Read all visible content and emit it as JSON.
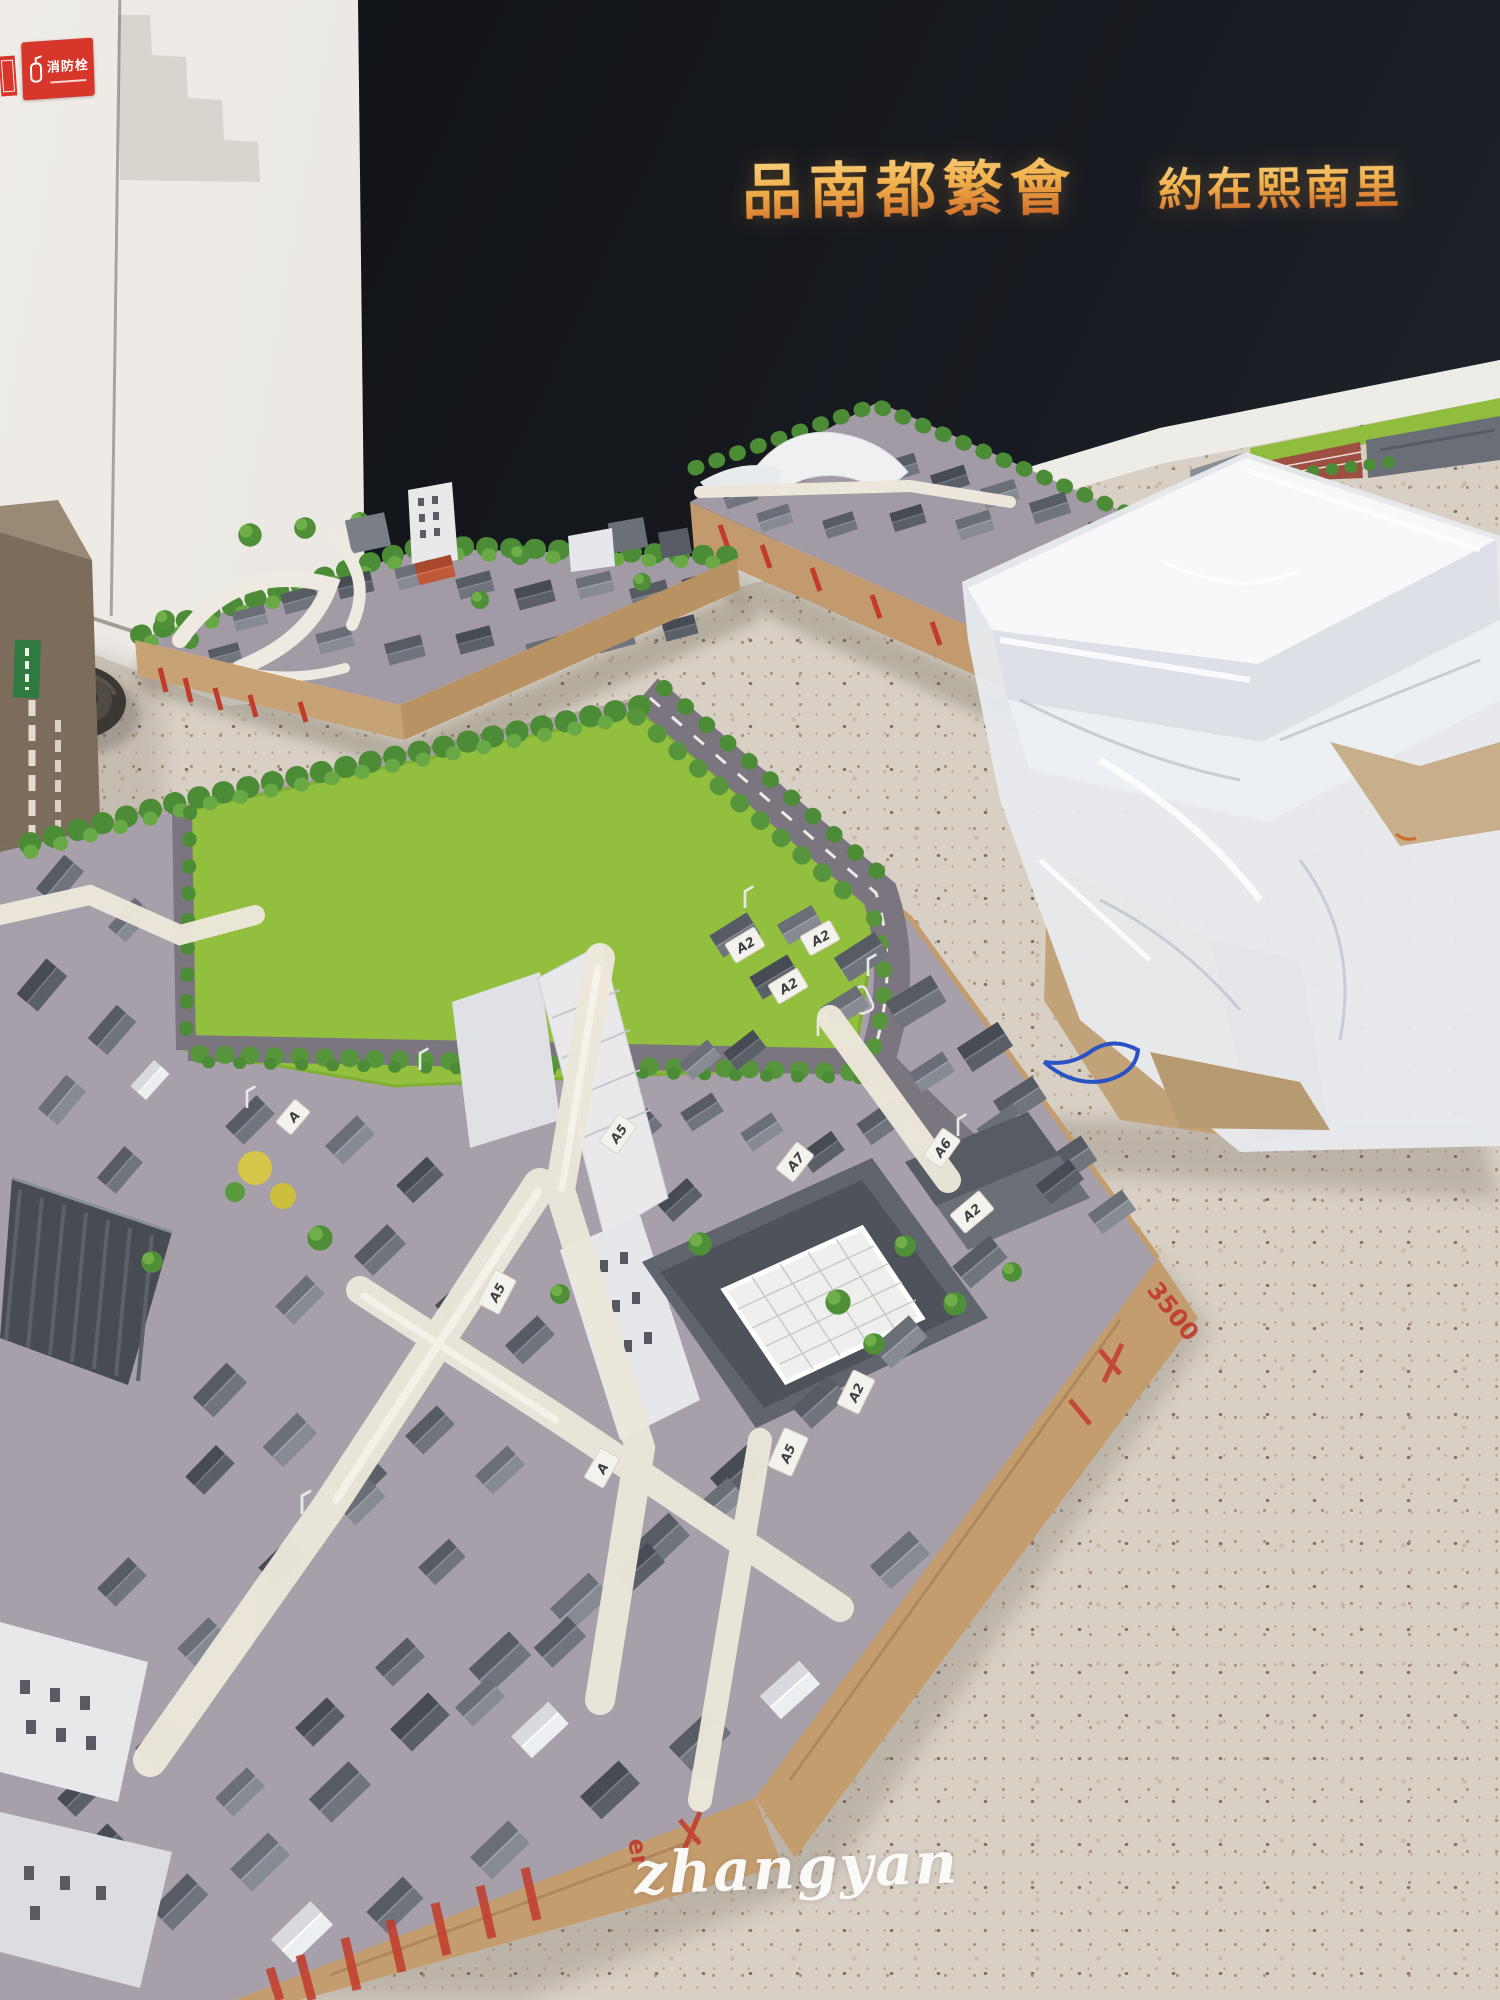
{
  "photo": {
    "watermark": "zhangyan"
  },
  "wall": {
    "slogan_left": "品南都繁會",
    "slogan_right": "約在熙南里",
    "slogan_gold_light": "#f8d98c",
    "slogan_gold_deep": "#c85a20",
    "wall_color": "#171a20"
  },
  "fire_hydrant_sign": {
    "title": "消防栓",
    "background": "#d7372b"
  },
  "main_model": {
    "building_tags": [
      {
        "text": "A2"
      },
      {
        "text": "A2"
      },
      {
        "text": "A2"
      },
      {
        "text": "A2"
      },
      {
        "text": "A5"
      },
      {
        "text": "A7"
      },
      {
        "text": "A6"
      },
      {
        "text": "A2"
      },
      {
        "text": "A5"
      },
      {
        "text": "A"
      },
      {
        "text": "A5"
      },
      {
        "text": "A"
      }
    ],
    "crate_marks": [
      {
        "text": "3500"
      },
      {
        "text": "er"
      }
    ],
    "grass_color": "#93bf3f",
    "road_color": "#7b7580",
    "roof_color": "#6b6f78",
    "crate_wood_color": "#c49d6e",
    "stamp_color": "#c23b2a",
    "tape_color": "#ece7da"
  },
  "side_models": {
    "red_roof": "#c0583a",
    "blue_roof": "#3f62a8",
    "brick_red": "#9e4f42"
  },
  "floor": {
    "terrazzo_base": "#d8d0c5"
  }
}
